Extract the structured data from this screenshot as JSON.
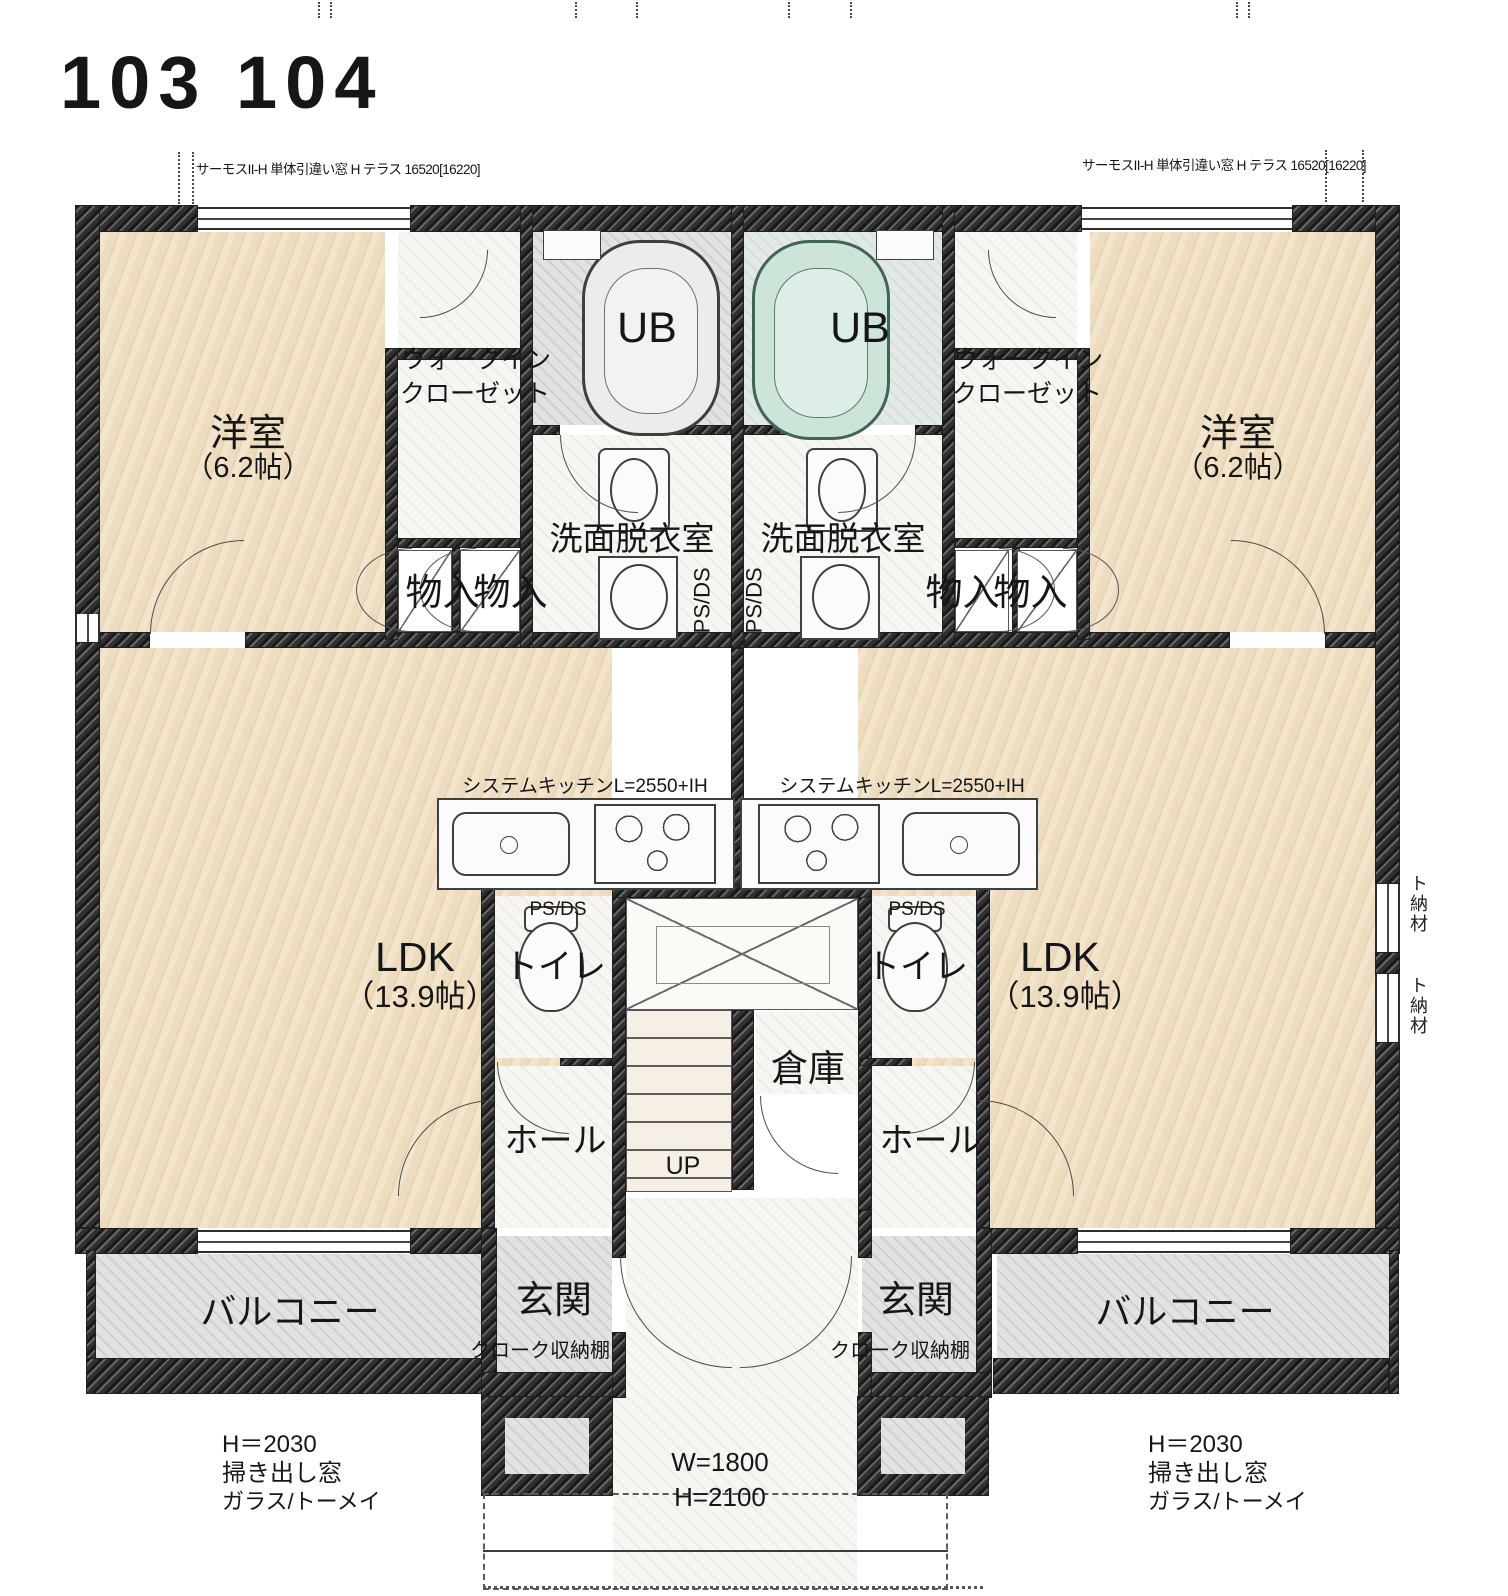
{
  "title": "103 104",
  "window_annotations": {
    "left": "サーモスII-H 単体引違い窓 H テラス 16520[16220]",
    "right": "サーモスII-H 単体引違い窓 H テラス 16520[16220]"
  },
  "labels": {
    "bedroom": "洋室",
    "bedroom_size": "（6.2帖）",
    "wic_line1": "ウォークイン",
    "wic_line2": "クローゼット",
    "ub": "UB",
    "washroom": "洗面脱衣室",
    "storage": "物入",
    "ps_ds": "PS/DS",
    "kitchen": "システムキッチンL=2550+IH",
    "ldk": "LDK",
    "ldk_size": "（13.9帖）",
    "toilet": "トイレ",
    "warehouse": "倉庫",
    "hall": "ホール",
    "up": "UP",
    "entrance": "玄関",
    "cloak_shelf": "クローク収納棚",
    "balcony": "バルコニー"
  },
  "dimensions": {
    "window_note_line1": "H＝2030",
    "window_note_line2": "掃き出し窓",
    "window_note_line3": "ガラス/トーメイ",
    "porch_width": "W=1800",
    "porch_height": "H=2100",
    "edge_note": "ト納材"
  }
}
